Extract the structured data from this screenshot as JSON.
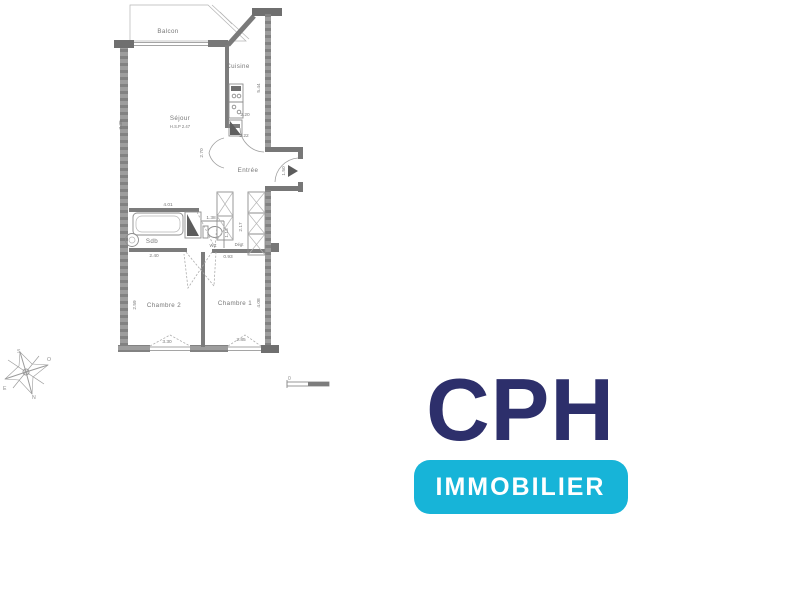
{
  "floor_plan": {
    "rooms": {
      "balcon": "Balcon",
      "cuisine": "Cuisine",
      "sejour": "Séjour",
      "sejour_note": "H.S.P 2.47",
      "entree": "Entrée",
      "sdb": "Sdb",
      "wc": "WC",
      "degt": "Dégt",
      "chambre2": "Chambre 2",
      "chambre1": "Chambre 1"
    },
    "dimensions": {
      "sejour_height": "7.39",
      "cuisine_height": "5.44",
      "cuisine_width": "2.20",
      "cuisine_door": "2.22",
      "entree_height": "2.70",
      "entree_door": "1.50",
      "sdb_top": "4.01",
      "wc_width": "1.38",
      "wc_depth": "1.13",
      "sdb_width": "2.40",
      "degt_width": "0.93",
      "placard_height": "2.17",
      "chambre2_height": "2.59",
      "chambre1_height": "4.08",
      "chambre2_window": "3.30",
      "chambre1_window": "2.85"
    },
    "compass": {
      "s": "S",
      "o": "O",
      "e": "E",
      "n": "N"
    },
    "scale": {
      "zero": "0"
    }
  },
  "logo": {
    "brand": "CPH",
    "tagline": "IMMOBILIER",
    "brand_color": "#2d2f6b",
    "badge_color": "#17b4d8"
  }
}
